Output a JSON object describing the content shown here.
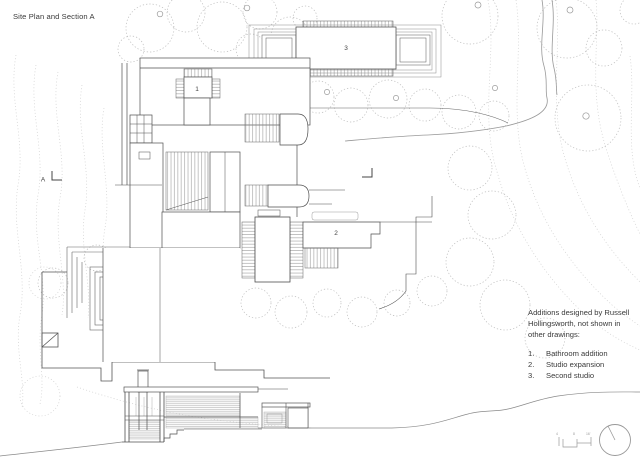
{
  "title": "Site Plan and Section A",
  "plan": {
    "label_1": "1",
    "label_2": "2",
    "label_3": "3",
    "section_letter": "A"
  },
  "notes": {
    "lines": [
      "Additions designed by Russell",
      "Hollingsworth, not shown in",
      "other drawings:"
    ],
    "items": [
      {
        "num": "1.",
        "text": "Bathroom addition"
      },
      {
        "num": "2.",
        "text": "Studio expansion"
      },
      {
        "num": "3.",
        "text": "Second studio"
      }
    ]
  },
  "legend": {
    "scale_ticks": [
      "4",
      "8",
      "16'"
    ]
  },
  "colors": {
    "background": "#ffffff",
    "line_dark": "#4f4f4f",
    "line_medium": "#8a8a8a",
    "line_light": "#c9c9c9",
    "hatch_fill": "#bdbdbd"
  }
}
